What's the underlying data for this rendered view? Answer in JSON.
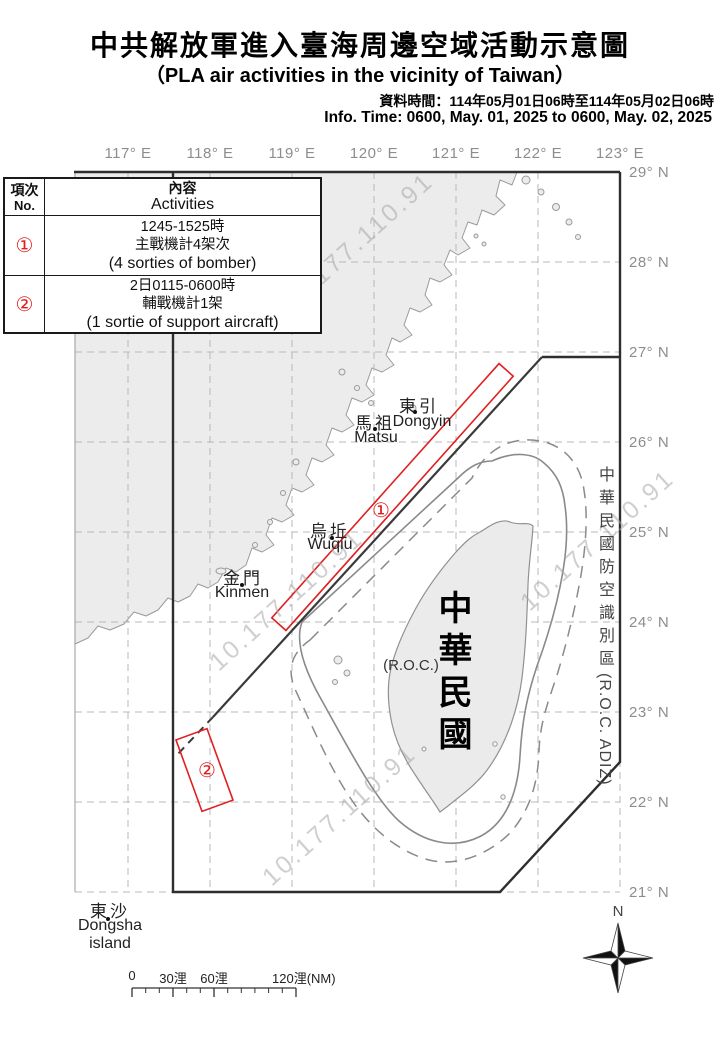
{
  "header": {
    "title_zh": "中共解放軍進入臺海周邊空域活動示意圖",
    "title_en": "（PLA air activities in the vicinity of Taiwan）",
    "info_zh": "資料時間：114年05月01日06時至114年05月02日06時",
    "info_en": "Info. Time: 0600, May. 01, 2025 to 0600, May. 02, 2025"
  },
  "table": {
    "no_header_zh": "項次",
    "no_header_en": "No.",
    "content_header_zh": "內容",
    "content_header_en": "Activities",
    "rows": [
      {
        "no": "①",
        "line1": "1245-1525時",
        "line2": "主戰機計4架次",
        "line3": "(4 sorties of bomber)"
      },
      {
        "no": "②",
        "line1": "2日0115-0600時",
        "line2": "輔戰機計1架",
        "line3": "(1 sortie of support aircraft)"
      }
    ]
  },
  "map": {
    "lon_labels": [
      "117° E",
      "118° E",
      "119° E",
      "120° E",
      "121° E",
      "122° E",
      "123° E"
    ],
    "lat_labels": [
      "29° N",
      "28° N",
      "27° N",
      "26° N",
      "25° N",
      "24° N",
      "23° N",
      "22° N",
      "21° N"
    ],
    "islands": {
      "dongyin": {
        "zh": "東引",
        "en": "Dongyin"
      },
      "matsu": {
        "zh": "馬祖",
        "en": "Matsu"
      },
      "wuqiu": {
        "zh": "烏坵",
        "en": "Wuqiu"
      },
      "kinmen": {
        "zh": "金門",
        "en": "Kinmen"
      },
      "dongsha": {
        "zh": "東沙",
        "en1": "Dongsha",
        "en2": "island"
      }
    },
    "roc": {
      "vertical_name": "中華民國",
      "paren": "(R.O.C.)"
    },
    "adiz_label": {
      "zh": "中華民國防空識別區",
      "en": "(R.O.C. ADIZ)"
    },
    "activity_markers": [
      "①",
      "②"
    ],
    "watermark": "10.177.110.91",
    "scale": {
      "labels": [
        "0",
        "30浬",
        "60浬",
        "120浬(NM)"
      ]
    },
    "compass": {
      "north_label": "N"
    }
  },
  "colors": {
    "accent_red": "#e02020",
    "boundary_black": "#2e2e2e",
    "grid_gray": "#b9b9b9",
    "land_fill": "#ececec",
    "label_gray": "#8d8d8d"
  }
}
